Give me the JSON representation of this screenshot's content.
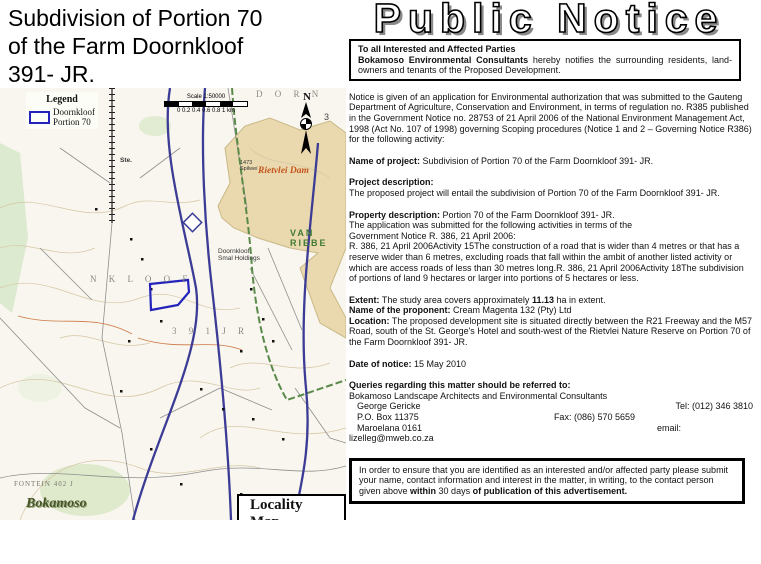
{
  "title": "Subdivision of Portion 70\nof the Farm Doornkloof\n391- JR.",
  "header": {
    "title": "Public Notice",
    "intro_box": {
      "line1": "To all Interested and Affected Parties",
      "bold_lead": "Bokamoso Environmental Consultants",
      "rest": " hereby notifies the surrounding residents, land-owners and tenants of the Proposed Development."
    }
  },
  "notice": {
    "intro": "Notice is given of an application for Environmental authorization that was submitted to the Gauteng Department of Agriculture, Conservation and Environment, in terms of regulation no. R385 published in the Government Notice no. 28753 of 21 April 2006 of the National Environment Management Act, 1998 (Act No. 107 of 1998) governing Scoping procedures (Notice 1 and 2 – Governing Notice R386) for the following activity:",
    "name_of_project": {
      "label": "Name of project:",
      "text": " Subdivision of Portion 70 of the Farm Doornkloof 391- JR."
    },
    "project_description": {
      "label": "Project description:",
      "text": "The proposed project will entail the subdivision of Portion 70 of the Farm Doornkloof 391- JR."
    },
    "property_description": {
      "label": "Property description:",
      "text": " Portion 70 of the Farm Doornkloof 391- JR.",
      "body": "The application was submitted for the following activities in terms of the\nGovernment Notice R. 386, 21 April 2006:\nR. 386, 21 April 2006Activity 15The construction of a road that is wider than 4 metres or that has a reserve wider than 6 metres, excluding roads that fall within the ambit of another listed activity or which are access roads of less than 30 metres long.R. 386, 21 April 2006Activity 18The subdivision of portions of land 9 hectares or larger into portions of 5 hectares or less."
    },
    "extent": {
      "label": "Extent:",
      "before": " The study area covers approximately ",
      "value": "11.13",
      "after": " ha in extent."
    },
    "proponent": {
      "label": "Name of the proponent:",
      "text": " Cream Magenta 132 (Pty) Ltd"
    },
    "location": {
      "label": "Location:",
      "text": " The proposed development site is situated directly between the R21 Freeway and the M57 Road, south of the St. George's Hotel and south-west of the Rietvlei Nature Reserve on Portion 70 of the Farm Doornkloof 391- JR."
    },
    "date_of_notice": {
      "label": "Date of notice:",
      "text": " 15 May 2010"
    },
    "queries": {
      "label": "Queries regarding this matter should be referred to:",
      "org": "Bokamoso Landscape Architects and Environmental Consultants",
      "contact_name": "George Gericke",
      "tel": "Tel: (012) 346 3810",
      "po_box": "P.O. Box 11375",
      "fax": "Fax: (086) 570 5659",
      "city": "Maroelana  0161",
      "email_label": "email:",
      "email": "lizelleg@mweb.co.za"
    },
    "response_box": {
      "part1": "In order to ensure that you are identified as an interested and/or affected party please submit your name, contact information and interest in the matter, in writing, to the contact person given above ",
      "bold1": "within",
      "part2": " 30 days ",
      "bold2": "of publication of this advertisement."
    }
  },
  "map": {
    "legend": {
      "title": "Legend",
      "item": "Doornkloof\nPortion 70"
    },
    "scale": {
      "title": "Scale 1:50000",
      "ticks": "0  0.2 0.4 0.6 0.8  1 km"
    },
    "north_label": "N",
    "labels": {
      "dam": "Rietvlei Dam",
      "holdings": "Doornkloof\nSmal Holdings",
      "van_riebe": "VAN RIEBE",
      "farm_391": "3 9 1   J R",
      "nkloof": "N K L O O F",
      "dorn": "D O R N",
      "spilwei": "1473\nSpilwei",
      "ste": "Ste.",
      "fontein": "FONTEIN 402 J",
      "three": "3"
    },
    "logo_text": "Bokamoso",
    "locality_label": "Locality Map"
  },
  "colors": {
    "site_outline": "#2323bb",
    "freeway_blue": "#3c3c96",
    "dam_fill": "#ead9ae",
    "dam_label": "#c4551c",
    "green_label": "#3f7a33"
  }
}
